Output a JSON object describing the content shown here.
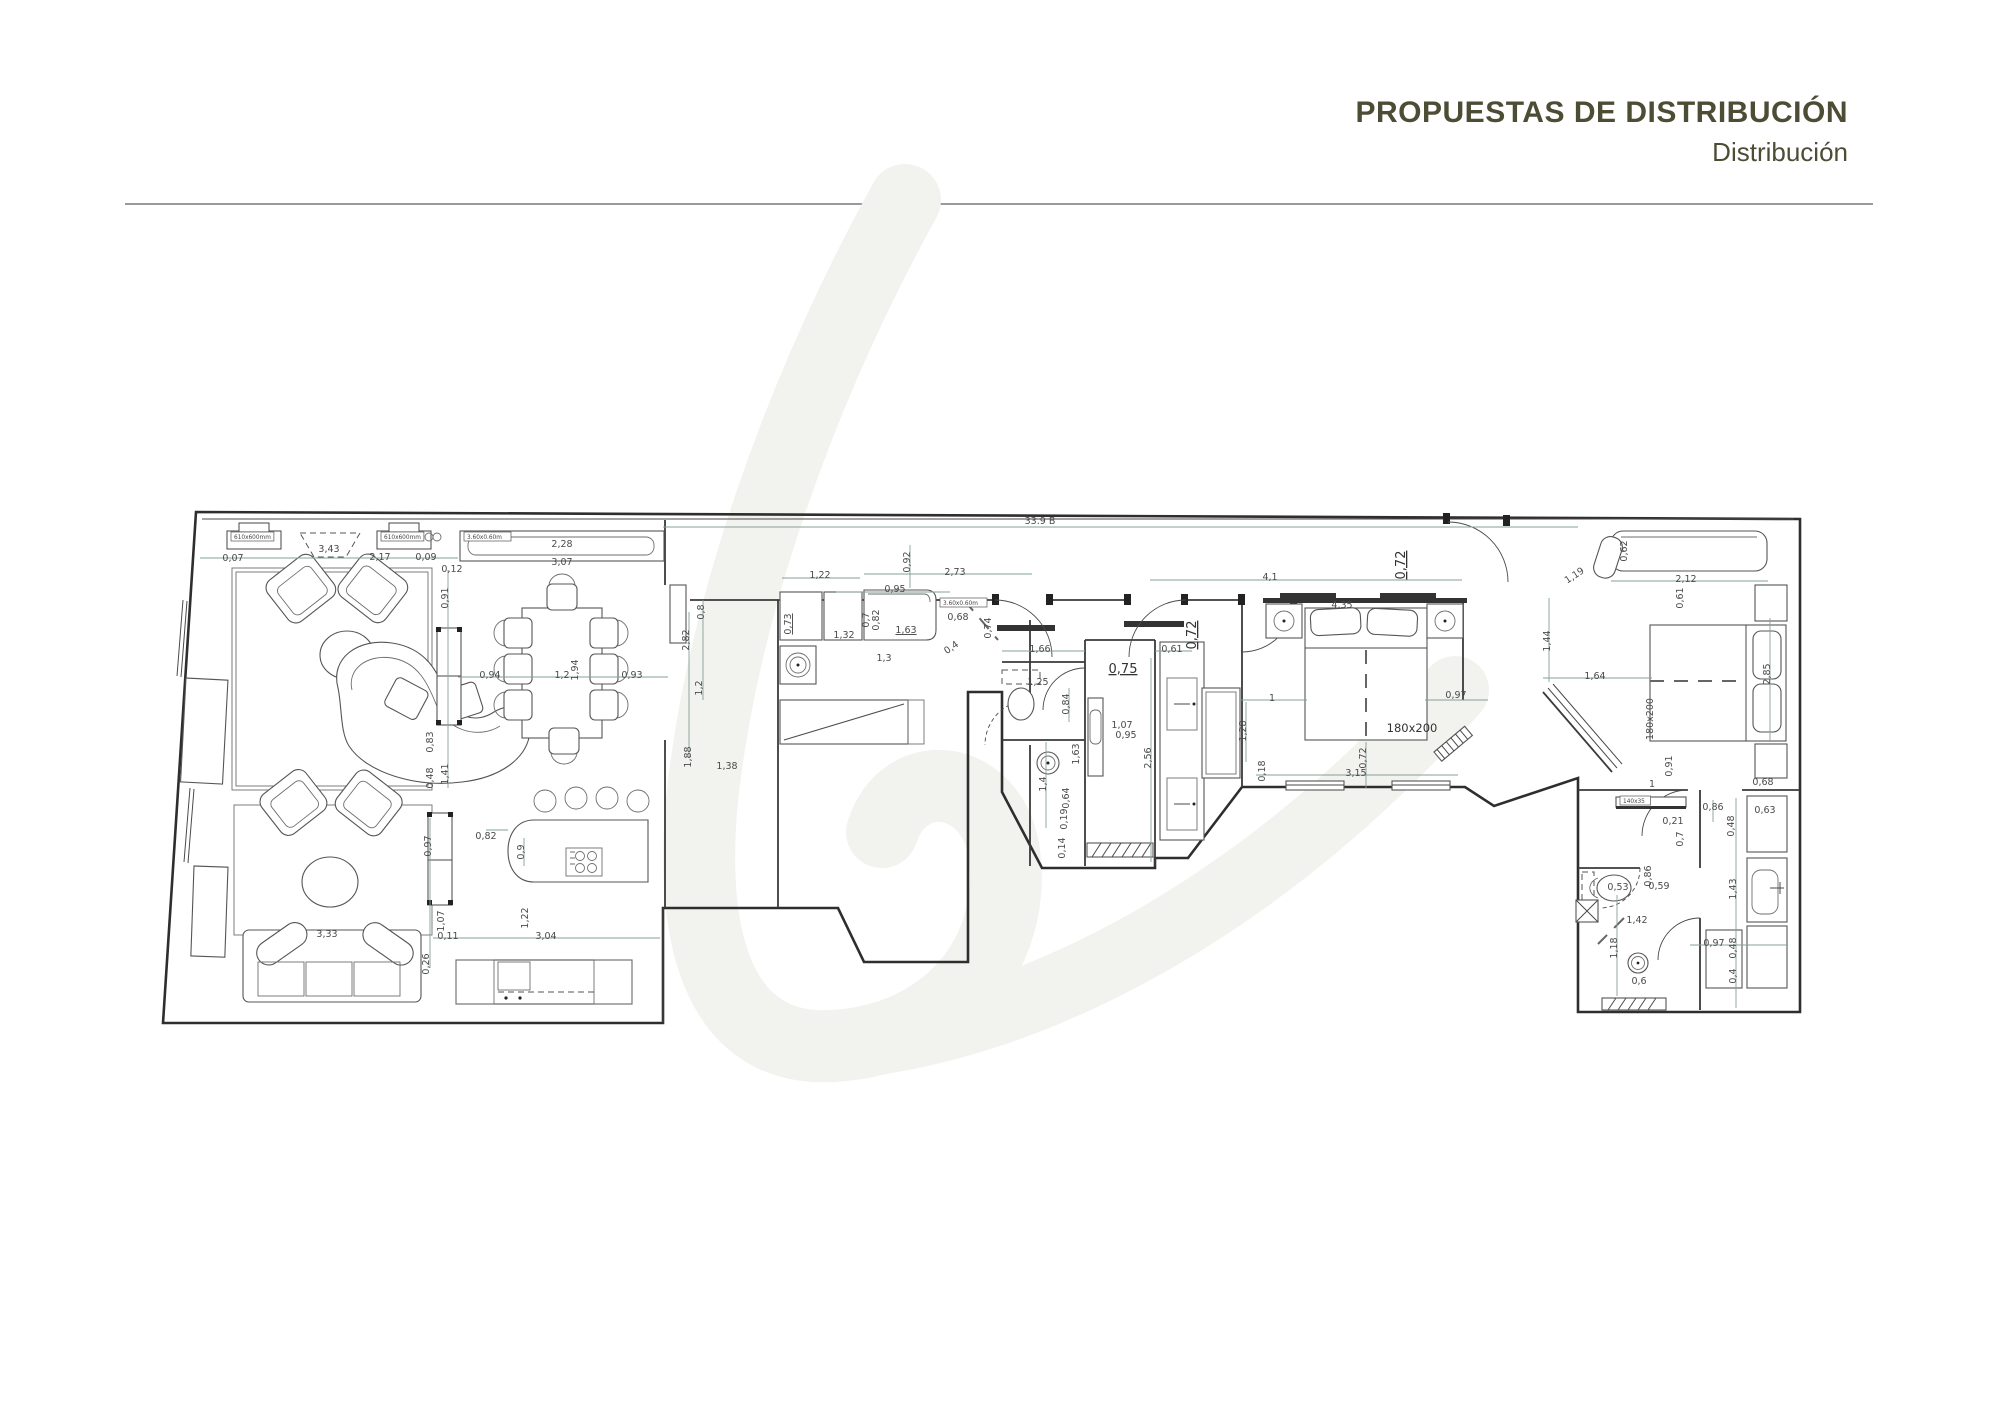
{
  "header": {
    "title": "PROPUESTAS DE DISTRIBUCIÓN",
    "subtitle": "Distribución"
  },
  "plan": {
    "labels": [
      {
        "t": "0,07",
        "x": 233,
        "y": 561
      },
      {
        "t": "3,43",
        "x": 329,
        "y": 552
      },
      {
        "t": "2,17",
        "x": 380,
        "y": 560
      },
      {
        "t": "0,09",
        "x": 426,
        "y": 560
      },
      {
        "t": "0,12",
        "x": 452,
        "y": 572
      },
      {
        "t": "0,91",
        "x": 448,
        "y": 598,
        "r": -90
      },
      {
        "t": "0,83",
        "x": 433,
        "y": 742,
        "r": -90
      },
      {
        "t": "0,48",
        "x": 433,
        "y": 778,
        "r": -90
      },
      {
        "t": "1,41",
        "x": 448,
        "y": 774,
        "r": -90
      },
      {
        "t": "2,28",
        "x": 562,
        "y": 547
      },
      {
        "t": "3,07",
        "x": 562,
        "y": 565
      },
      {
        "t": "0,94",
        "x": 490,
        "y": 678
      },
      {
        "t": "1,2",
        "x": 562,
        "y": 678
      },
      {
        "t": "1,94",
        "x": 578,
        "y": 670,
        "r": -90
      },
      {
        "t": "0,93",
        "x": 632,
        "y": 678
      },
      {
        "t": "2,82",
        "x": 689,
        "y": 640,
        "r": -90
      },
      {
        "t": "0,8",
        "x": 704,
        "y": 612,
        "r": -90
      },
      {
        "t": "1,2",
        "x": 702,
        "y": 688,
        "r": -90
      },
      {
        "t": "1,88",
        "x": 691,
        "y": 757,
        "r": -90
      },
      {
        "t": "1,38",
        "x": 727,
        "y": 769
      },
      {
        "t": "33.9 B",
        "x": 1040,
        "y": 524
      },
      {
        "t": "4,1",
        "x": 1270,
        "y": 580
      },
      {
        "t": "4,35",
        "x": 1342,
        "y": 608
      },
      {
        "t": "0,72",
        "x": 1405,
        "y": 565,
        "r": -90,
        "u": true,
        "big": true
      },
      {
        "t": "0,72",
        "x": 1196,
        "y": 635,
        "r": -90,
        "u": true,
        "big": true
      },
      {
        "t": "0,75",
        "x": 1123,
        "y": 673,
        "u": true,
        "big": true
      },
      {
        "t": "1,22",
        "x": 820,
        "y": 578
      },
      {
        "t": "2,73",
        "x": 955,
        "y": 575
      },
      {
        "t": "0,95",
        "x": 895,
        "y": 592
      },
      {
        "t": "0,92",
        "x": 910,
        "y": 562,
        "r": -90
      },
      {
        "t": "0,73",
        "x": 791,
        "y": 624,
        "r": -90,
        "u": true
      },
      {
        "t": "0,7",
        "x": 869,
        "y": 620,
        "r": -90
      },
      {
        "t": "0,82",
        "x": 879,
        "y": 620,
        "r": -90
      },
      {
        "t": "1,63",
        "x": 906,
        "y": 633,
        "u": true
      },
      {
        "t": "0,68",
        "x": 958,
        "y": 620
      },
      {
        "t": "1,32",
        "x": 844,
        "y": 638
      },
      {
        "t": "1,3",
        "x": 884,
        "y": 661
      },
      {
        "t": "0,4",
        "x": 953,
        "y": 650,
        "r": -35
      },
      {
        "t": "0,74",
        "x": 991,
        "y": 628,
        "r": -90
      },
      {
        "t": "1,66",
        "x": 1040,
        "y": 652
      },
      {
        "t": "0,61",
        "x": 1172,
        "y": 652
      },
      {
        "t": "1,25",
        "x": 1038,
        "y": 685
      },
      {
        "t": "0,84",
        "x": 1069,
        "y": 704,
        "r": -90
      },
      {
        "t": "1,07",
        "x": 1122,
        "y": 728
      },
      {
        "t": "0,95",
        "x": 1126,
        "y": 738
      },
      {
        "t": "2,56",
        "x": 1151,
        "y": 758,
        "r": -90
      },
      {
        "t": "1,63",
        "x": 1079,
        "y": 754,
        "r": -90
      },
      {
        "t": "1,4",
        "x": 1046,
        "y": 784,
        "r": -90
      },
      {
        "t": "0,64",
        "x": 1069,
        "y": 798,
        "r": -90
      },
      {
        "t": "0,19",
        "x": 1067,
        "y": 819,
        "r": -90
      },
      {
        "t": "0,14",
        "x": 1065,
        "y": 848,
        "r": -90
      },
      {
        "t": "1",
        "x": 1272,
        "y": 701
      },
      {
        "t": "0,97",
        "x": 1456,
        "y": 698
      },
      {
        "t": "1,28",
        "x": 1246,
        "y": 731,
        "r": -90
      },
      {
        "t": "0,72",
        "x": 1366,
        "y": 758,
        "r": -90
      },
      {
        "t": "3,15",
        "x": 1356,
        "y": 776
      },
      {
        "t": "0,18",
        "x": 1265,
        "y": 771,
        "r": -90
      },
      {
        "t": "180x200",
        "x": 1412,
        "y": 732,
        "med": true
      },
      {
        "t": "0,62",
        "x": 1627,
        "y": 551,
        "r": -90
      },
      {
        "t": "2,12",
        "x": 1686,
        "y": 582
      },
      {
        "t": "0,61",
        "x": 1683,
        "y": 598,
        "r": -90
      },
      {
        "t": "1,19",
        "x": 1576,
        "y": 578,
        "r": -33
      },
      {
        "t": "1,44",
        "x": 1550,
        "y": 641,
        "r": -90
      },
      {
        "t": "1,64",
        "x": 1595,
        "y": 679
      },
      {
        "t": "2,85",
        "x": 1770,
        "y": 674,
        "r": -90
      },
      {
        "t": "180x200",
        "x": 1653,
        "y": 719,
        "r": -90
      },
      {
        "t": "0,91",
        "x": 1672,
        "y": 766,
        "r": -90
      },
      {
        "t": "1",
        "x": 1652,
        "y": 787
      },
      {
        "t": "0,68",
        "x": 1763,
        "y": 785
      },
      {
        "t": "0,63",
        "x": 1765,
        "y": 813
      },
      {
        "t": "0,86",
        "x": 1713,
        "y": 810
      },
      {
        "t": "0,48",
        "x": 1734,
        "y": 826,
        "r": -90
      },
      {
        "t": "0,21",
        "x": 1673,
        "y": 824
      },
      {
        "t": "0,7",
        "x": 1683,
        "y": 839,
        "r": -90
      },
      {
        "t": "1,43",
        "x": 1736,
        "y": 889,
        "r": -90
      },
      {
        "t": "0,53",
        "x": 1618,
        "y": 890
      },
      {
        "t": "0,86",
        "x": 1651,
        "y": 876,
        "r": -90
      },
      {
        "t": "0,59",
        "x": 1659,
        "y": 889
      },
      {
        "t": "1,42",
        "x": 1637,
        "y": 923
      },
      {
        "t": "1,18",
        "x": 1617,
        "y": 948,
        "r": -90
      },
      {
        "t": "0,6",
        "x": 1639,
        "y": 984
      },
      {
        "t": "0,97",
        "x": 1714,
        "y": 946
      },
      {
        "t": "0,48",
        "x": 1736,
        "y": 948,
        "r": -90
      },
      {
        "t": "0,4",
        "x": 1736,
        "y": 976,
        "r": -90
      },
      {
        "t": "0,82",
        "x": 486,
        "y": 839
      },
      {
        "t": "0,9",
        "x": 524,
        "y": 852,
        "r": -90
      },
      {
        "t": "1,22",
        "x": 528,
        "y": 918,
        "r": -90
      },
      {
        "t": "3,04",
        "x": 546,
        "y": 939
      },
      {
        "t": "0,11",
        "x": 448,
        "y": 939
      },
      {
        "t": "1,07",
        "x": 444,
        "y": 921,
        "r": -90
      },
      {
        "t": "0,97",
        "x": 431,
        "y": 846,
        "r": -90
      },
      {
        "t": "0,26",
        "x": 429,
        "y": 964,
        "r": -90
      },
      {
        "t": "3,33",
        "x": 327,
        "y": 937
      }
    ],
    "tags": [
      {
        "t": "610x600mm",
        "x": 231,
        "y": 532
      },
      {
        "t": "610x600mm",
        "x": 381,
        "y": 532
      },
      {
        "t": "3.60x0.60m",
        "x": 464,
        "y": 532
      },
      {
        "t": "3.60x0.60m",
        "x": 940,
        "y": 598
      },
      {
        "t": "140x35",
        "x": 1620,
        "y": 796
      }
    ]
  }
}
